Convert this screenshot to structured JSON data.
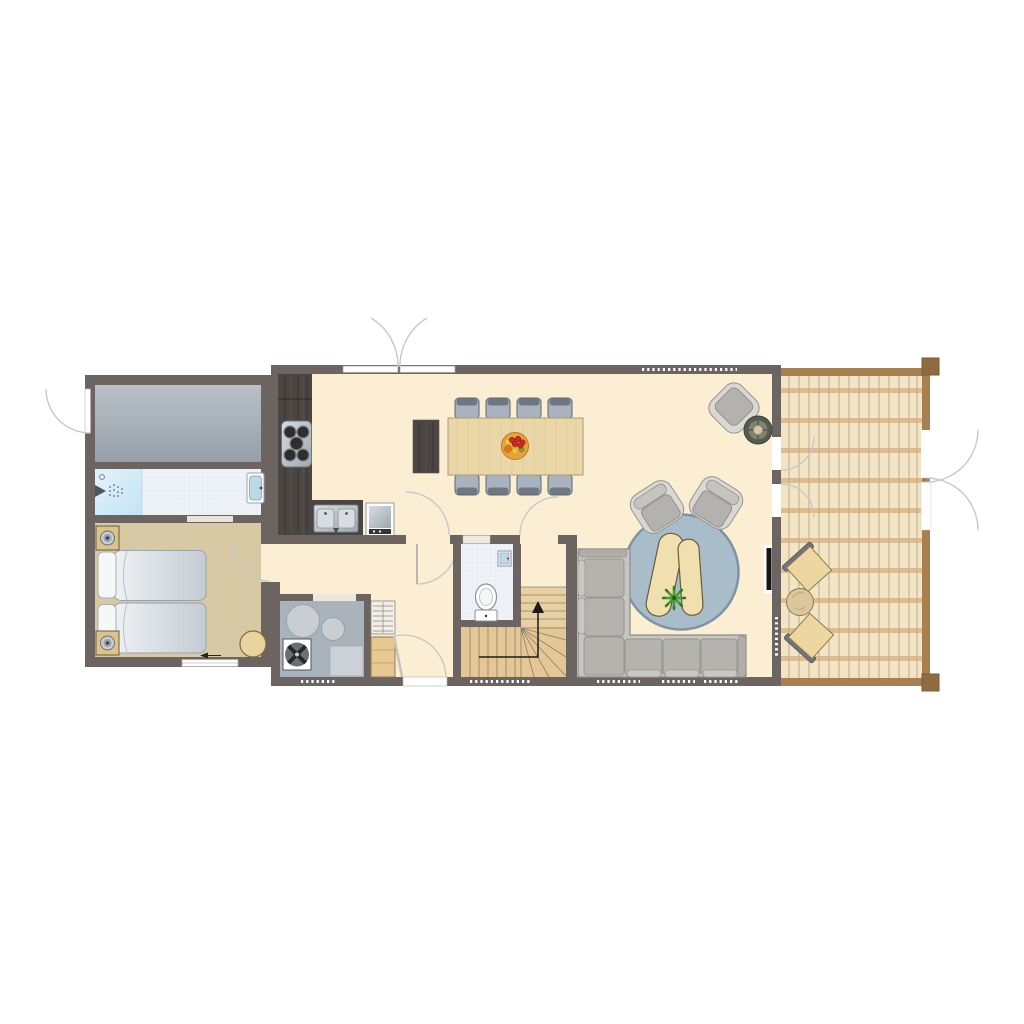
{
  "canvas": {
    "width": 1024,
    "height": 1024,
    "background": "#FFFFFF"
  },
  "colors": {
    "wall": "#6B6460",
    "floor_main": "#FBEED3",
    "floor_bedroom": "#D6C9A3",
    "floor_bath": "#EFF3F8",
    "bath_grid": "#D9E3EC",
    "shower_light": "#E3F2FB",
    "shower_dark": "#C2E4F5",
    "storage_top": "#B9C0C7",
    "storage_bottom": "#96A0A9",
    "floor_utility": "#A8B3BC",
    "deck_base": "#F3E5C3",
    "deck_plank_line": "#B6AD9D",
    "deck_beam": "#DDBC8E",
    "deck_frame": "#A87F50",
    "deck_post": "#8F6B40",
    "stairs_wood": "#E9D0A2",
    "stairs_wood_dark": "#E4C795",
    "stairs_line": "#8A7F68",
    "closet_wood": "#E7C892",
    "counter_dark": "#4B4543",
    "steel_light": "#D6DCE1",
    "steel_dark": "#9FA8AF",
    "table_wood": "#EAD7A7",
    "table_border": "#A79B77",
    "chair_body": "#A9B3C0",
    "chair_back": "#6F7782",
    "chair_border": "#5E6670",
    "sofa_frame": "#C7C5C0",
    "sofa_cushion": "#B5B3AE",
    "sofa_border": "#8E8C87",
    "rug": "#A9BCC9",
    "rug_border": "#7E93A3",
    "armchair_frame": "#DAD8D2",
    "armchair_cushion": "#B4B2AE",
    "coffee_table": "#F0DFAF",
    "coffee_border": "#6B5B3A",
    "plant_dark": "#2E7A1E",
    "plant_light": "#49A32B",
    "stool_ring": "#565B50",
    "stool_center": "#D3C7A6",
    "bowl": "#E8A33D",
    "fruit_red": "#CC2A22",
    "fruit_orange": "#E07818",
    "fruit_yellow": "#E8C83C",
    "bed_border": "#9AA2AB",
    "duvet_light": "#EFF2F5",
    "duvet_dark": "#C4CBD3",
    "pillow": "#F5F7F9",
    "nightstand": "#DBC489",
    "pouf": "#E9D49E",
    "door_arc": "#C8C8C8",
    "wc_border": "#8A9099",
    "basin_blue": "#BCD9E8",
    "washer": "#CBD1D6",
    "boiler": "#C9CED3",
    "fan_dark": "#23282C",
    "tv_black": "#161616",
    "window_white": "#FFFFFF"
  },
  "legend": {
    "drawing_type": "floor-plan",
    "rooms": [
      "storage-room",
      "bathroom",
      "bedroom",
      "kitchen",
      "dining-area",
      "living-area",
      "hallway",
      "toilet",
      "staircase",
      "utility-room",
      "deck-terrace"
    ],
    "furniture_icons": [
      "twin-beds-icon",
      "nightstand-lamp-icon",
      "shower-icon",
      "washbasin-icon",
      "hob-icon",
      "kitchen-sink-icon",
      "built-in-oven-icon",
      "sideboard-icon",
      "dining-table-icon",
      "dining-chair-icon",
      "fruit-bowl-icon",
      "corner-sofa-icon",
      "round-rug-icon",
      "armchair-icon",
      "coffee-table-icon",
      "plant-icon",
      "side-stool-icon",
      "tv-icon",
      "toilet-icon",
      "hand-basin-icon",
      "stairs-up-arrow-icon",
      "boiler-icon",
      "ventilation-fan-icon",
      "washing-machine-icon",
      "shelf-closet-icon",
      "wardrobe-cabinet-icon",
      "deck-chair-icon",
      "deck-table-icon",
      "pouf-icon",
      "door-swing-arc-icon",
      "window-strip-icon",
      "double-entry-door-icon"
    ]
  }
}
